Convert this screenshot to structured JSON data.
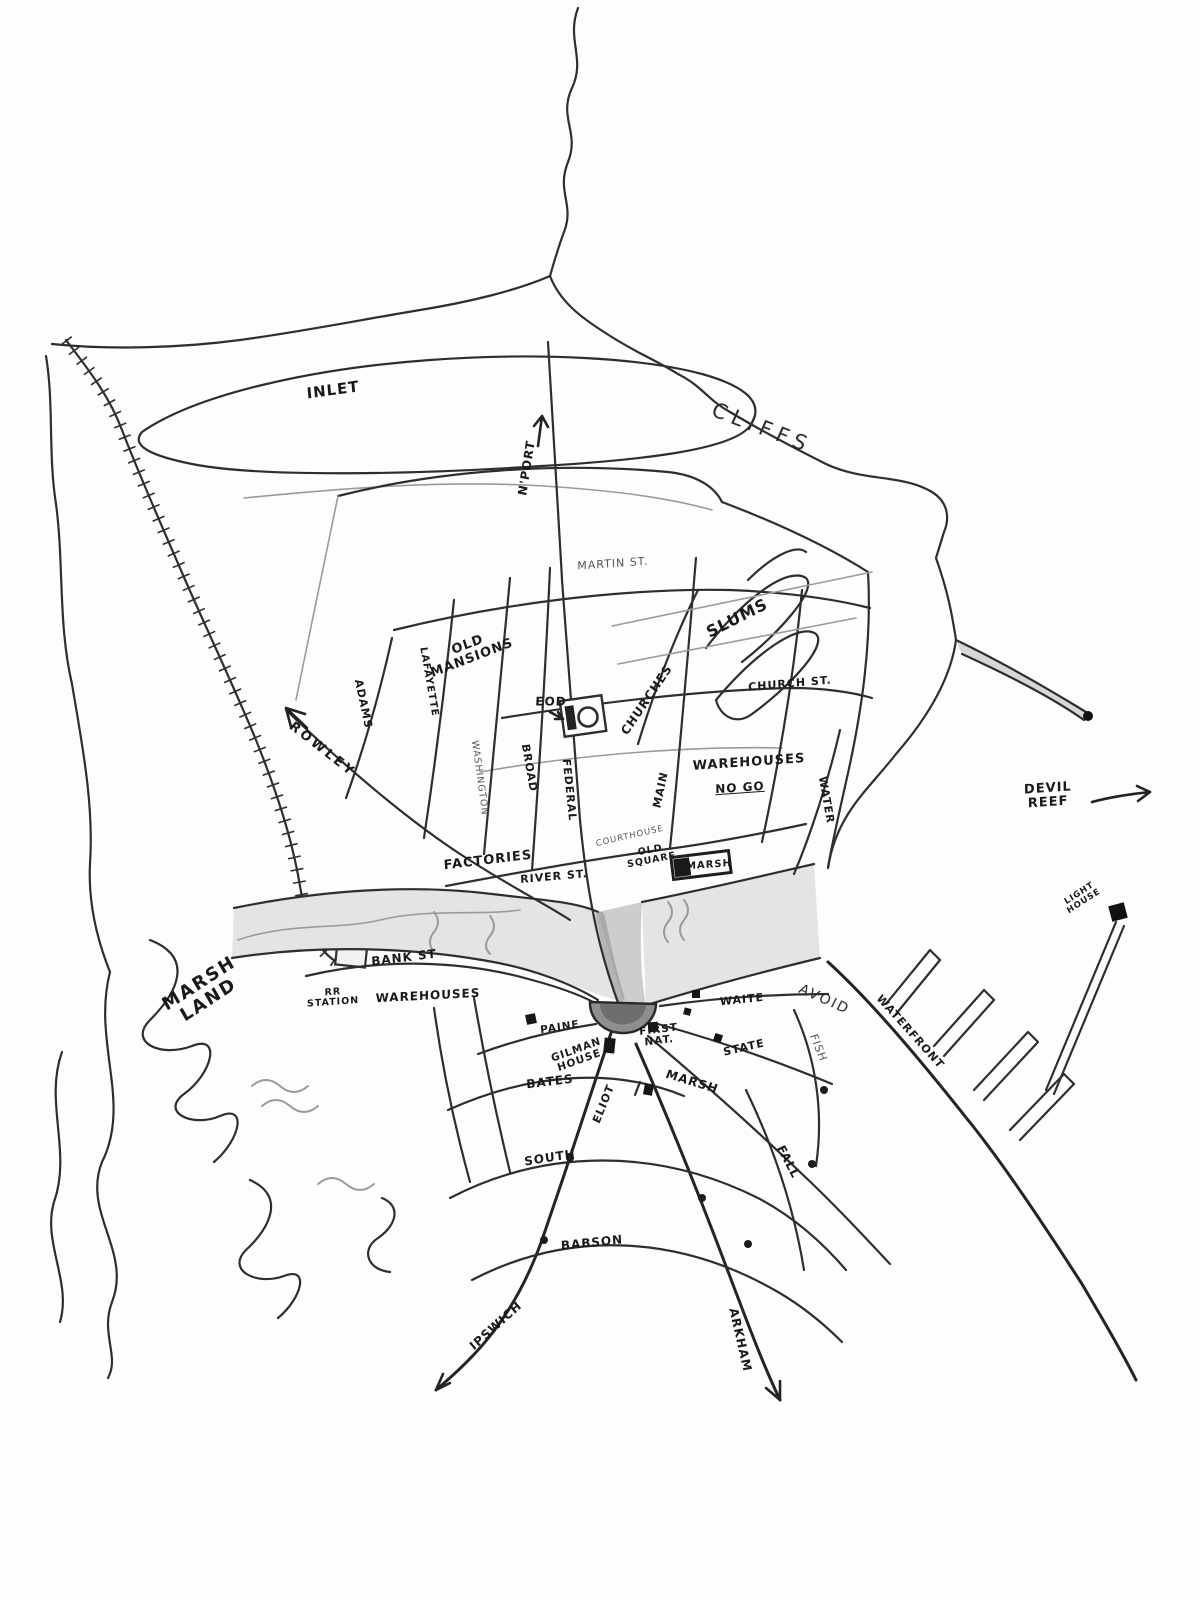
{
  "map": {
    "description": "Hand-drawn pencil sketch map of a coastal town with river, railroad, marsh land and harbor",
    "colors": {
      "ink": "#2e2e2e",
      "paper": "#fdfdfc",
      "river_fill": "#e4e4e3",
      "gorge_fill": "#cdcdcc",
      "square_fill": "#8f8f8f",
      "building": "#161616"
    }
  },
  "labels": {
    "inlet": {
      "text": "INLET",
      "x": 333,
      "y": 390,
      "r": -8,
      "s": 15,
      "cls": "bold"
    },
    "cliffs": {
      "text": "CLIFFS",
      "x": 762,
      "y": 428,
      "r": 21,
      "s": 21,
      "ls": 6
    },
    "nport": {
      "text": "N'PORT",
      "x": 527,
      "y": 468,
      "r": -81,
      "s": 12,
      "cls": "bold"
    },
    "martin_st": {
      "text": "MARTIN ST.",
      "x": 613,
      "y": 564,
      "r": -4,
      "s": 11,
      "cls": "light"
    },
    "slums": {
      "text": "SLUMS",
      "x": 737,
      "y": 618,
      "r": -27,
      "s": 16,
      "cls": "bold"
    },
    "old_mansions": {
      "text": "OLD\nMANSIONS",
      "x": 470,
      "y": 652,
      "r": -21,
      "s": 13,
      "cls": "bold"
    },
    "adams_n": {
      "text": "ADAMS",
      "x": 363,
      "y": 704,
      "r": 78,
      "s": 11,
      "cls": "bold"
    },
    "lafayette_n": {
      "text": "LAFAYETTE",
      "x": 428,
      "y": 682,
      "r": 80,
      "s": 10,
      "cls": "bold"
    },
    "washington": {
      "text": "WASHINGTON",
      "x": 479,
      "y": 778,
      "r": 82,
      "s": 9.5,
      "cls": "light"
    },
    "broad": {
      "text": "BROAD",
      "x": 529,
      "y": 768,
      "r": 80,
      "s": 11,
      "cls": "bold"
    },
    "federal": {
      "text": "FEDERAL",
      "x": 569,
      "y": 790,
      "r": 84,
      "s": 11,
      "cls": "bold"
    },
    "eod": {
      "text": "EOD",
      "x": 551,
      "y": 702,
      "r": 0,
      "s": 12,
      "cls": "bold"
    },
    "churches": {
      "text": "CHURCHES",
      "x": 647,
      "y": 700,
      "r": -56,
      "s": 12,
      "cls": "bold"
    },
    "church_st": {
      "text": "CHURCH ST.",
      "x": 790,
      "y": 684,
      "r": -5,
      "s": 11,
      "cls": "bold"
    },
    "main": {
      "text": "MAIN",
      "x": 661,
      "y": 790,
      "r": -78,
      "s": 11,
      "cls": "bold"
    },
    "warehouses_n": {
      "text": "WAREHOUSES",
      "x": 749,
      "y": 763,
      "r": -4,
      "s": 13,
      "cls": "bold"
    },
    "no_go": {
      "text": "NO GO",
      "x": 740,
      "y": 788,
      "r": -4,
      "s": 12,
      "cls": "bold underline"
    },
    "water": {
      "text": "WATER",
      "x": 826,
      "y": 800,
      "r": 80,
      "s": 11,
      "cls": "bold"
    },
    "rowley": {
      "text": "ROWLEY",
      "x": 322,
      "y": 750,
      "r": 38,
      "s": 13,
      "cls": "bold",
      "ls": 3
    },
    "devil_reef": {
      "text": "DEVIL\nREEF",
      "x": 1048,
      "y": 796,
      "r": -4,
      "s": 13,
      "cls": "bold"
    },
    "factories": {
      "text": "FACTORIES",
      "x": 488,
      "y": 861,
      "r": -7,
      "s": 13,
      "cls": "bold"
    },
    "river_st": {
      "text": "RIVER ST.",
      "x": 554,
      "y": 877,
      "r": -5,
      "s": 11,
      "cls": "bold"
    },
    "courthouse": {
      "text": "COURTHOUSE",
      "x": 630,
      "y": 837,
      "r": -13,
      "s": 8.5,
      "cls": "light"
    },
    "old_square": {
      "text": "OLD\nSQUARE",
      "x": 651,
      "y": 856,
      "r": -11,
      "s": 9.5,
      "cls": "bold"
    },
    "marsh_refinery": {
      "text": "MARSH",
      "x": 709,
      "y": 866,
      "r": -4,
      "s": 10,
      "cls": "bold"
    },
    "light_house": {
      "text": "LIGHT\nHOUSE",
      "x": 1082,
      "y": 898,
      "r": -33,
      "s": 8.5,
      "cls": "bold"
    },
    "bank_st": {
      "text": "BANK ST",
      "x": 404,
      "y": 958,
      "r": -7,
      "s": 12,
      "cls": "bold"
    },
    "rr_station": {
      "text": "RR\nSTATION",
      "x": 333,
      "y": 998,
      "r": -4,
      "s": 9.5,
      "cls": "bold"
    },
    "warehouses_s": {
      "text": "WAREHOUSES",
      "x": 428,
      "y": 996,
      "r": -3,
      "s": 12,
      "cls": "bold"
    },
    "marsh_land": {
      "text": "MARSH\nLAND",
      "x": 204,
      "y": 992,
      "r": -33,
      "s": 18,
      "cls": "bold",
      "ls": 2
    },
    "paine": {
      "text": "PAINE",
      "x": 560,
      "y": 1028,
      "r": -9,
      "s": 10.5,
      "cls": "bold"
    },
    "gilman_house": {
      "text": "GILMAN\nHOUSE",
      "x": 578,
      "y": 1056,
      "r": -20,
      "s": 10.5,
      "cls": "bold"
    },
    "first_nat": {
      "text": "FIRST\nNAT.",
      "x": 659,
      "y": 1036,
      "r": -7,
      "s": 10.5,
      "cls": "bold"
    },
    "waite": {
      "text": "WAITE",
      "x": 742,
      "y": 1000,
      "r": -6,
      "s": 11,
      "cls": "bold"
    },
    "state": {
      "text": "STATE",
      "x": 744,
      "y": 1048,
      "r": -13,
      "s": 11,
      "cls": "bold"
    },
    "avoid": {
      "text": "AVOID",
      "x": 824,
      "y": 1000,
      "r": 24,
      "s": 14,
      "ls": 2
    },
    "fish": {
      "text": "FISH",
      "x": 818,
      "y": 1048,
      "r": 68,
      "s": 11,
      "cls": "light"
    },
    "waterfront": {
      "text": "WATERFRONT",
      "x": 910,
      "y": 1032,
      "r": 48,
      "s": 11,
      "cls": "bold"
    },
    "bates": {
      "text": "BATES",
      "x": 550,
      "y": 1082,
      "r": -7,
      "s": 12,
      "cls": "bold"
    },
    "eliot": {
      "text": "ELIOT",
      "x": 604,
      "y": 1104,
      "r": -68,
      "s": 11,
      "cls": "bold"
    },
    "marsh_st": {
      "text": "MARSH",
      "x": 692,
      "y": 1082,
      "r": 17,
      "s": 12,
      "cls": "bold"
    },
    "south_st": {
      "text": "SOUTH",
      "x": 550,
      "y": 1158,
      "r": -9,
      "s": 12,
      "cls": "bold"
    },
    "fall": {
      "text": "FALL",
      "x": 788,
      "y": 1162,
      "r": 62,
      "s": 12,
      "cls": "bold"
    },
    "babson": {
      "text": "BABSON",
      "x": 592,
      "y": 1243,
      "r": -6,
      "s": 12,
      "cls": "bold"
    },
    "ipswich": {
      "text": "IPSWICH",
      "x": 496,
      "y": 1326,
      "r": -42,
      "s": 12,
      "cls": "bold"
    },
    "arkham": {
      "text": "ARKHAM",
      "x": 740,
      "y": 1340,
      "r": 77,
      "s": 12,
      "cls": "bold"
    }
  }
}
